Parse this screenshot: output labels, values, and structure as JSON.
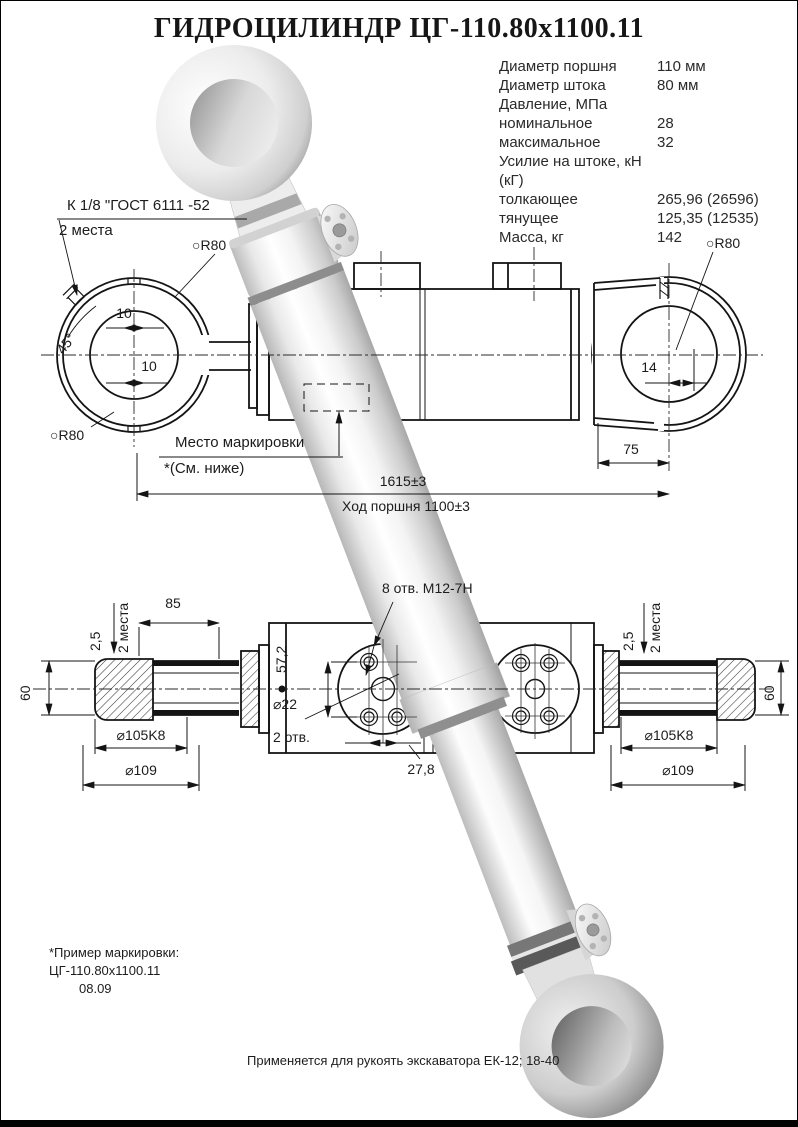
{
  "title": "ГИДРОЦИЛИНДР ЦГ-110.80х1100.11",
  "specs": {
    "rows": [
      {
        "label": "Диаметр поршня",
        "value": "110 мм"
      },
      {
        "label": "Диаметр штока",
        "value": "80 мм"
      },
      {
        "label": "Давление, МПа",
        "value": ""
      },
      {
        "label": "номинальное",
        "value": "28"
      },
      {
        "label": "максимальное",
        "value": "32"
      },
      {
        "label": "Усилие на штоке, кН (кГ)",
        "value": ""
      },
      {
        "label": "толкающее",
        "value": "265,96 (26596)"
      },
      {
        "label": "тянущее",
        "value": "125,35 (12535)"
      },
      {
        "label": "Масса, кг",
        "value": "142"
      }
    ]
  },
  "drawing": {
    "port_note": "К 1/8 \"ГОСТ 6111 -52",
    "two_places": "2 места",
    "radius_label": "○R80",
    "dim_10": "10",
    "angle_45": "45°",
    "dim_14": "14",
    "dim_75": "75",
    "marking_place": "Место маркировки",
    "see_below": "*(См. ниже)",
    "overall_length": "1615±3",
    "piston_stroke": "Ход поршня 1100±3"
  },
  "section": {
    "dim_85": "85",
    "dim_2_5": "2,5",
    "two_places": "2 места",
    "dim_60": "60",
    "dia_105": "⌀105K8",
    "dia_109": "⌀109",
    "holes_8": "8 отв. М12-7Н",
    "dim_57_2": "57,2",
    "dia_22": "⌀22",
    "holes_2": "2 отв.",
    "dim_27_8": "27,8"
  },
  "notes": {
    "marking_example_label": "*Пример маркировки:",
    "marking_example_value": "ЦГ-110.80х1100.11",
    "marking_example_date": "08.09",
    "application": "Применяется для рукоять экскаватора ЕК-12; 18-40"
  }
}
